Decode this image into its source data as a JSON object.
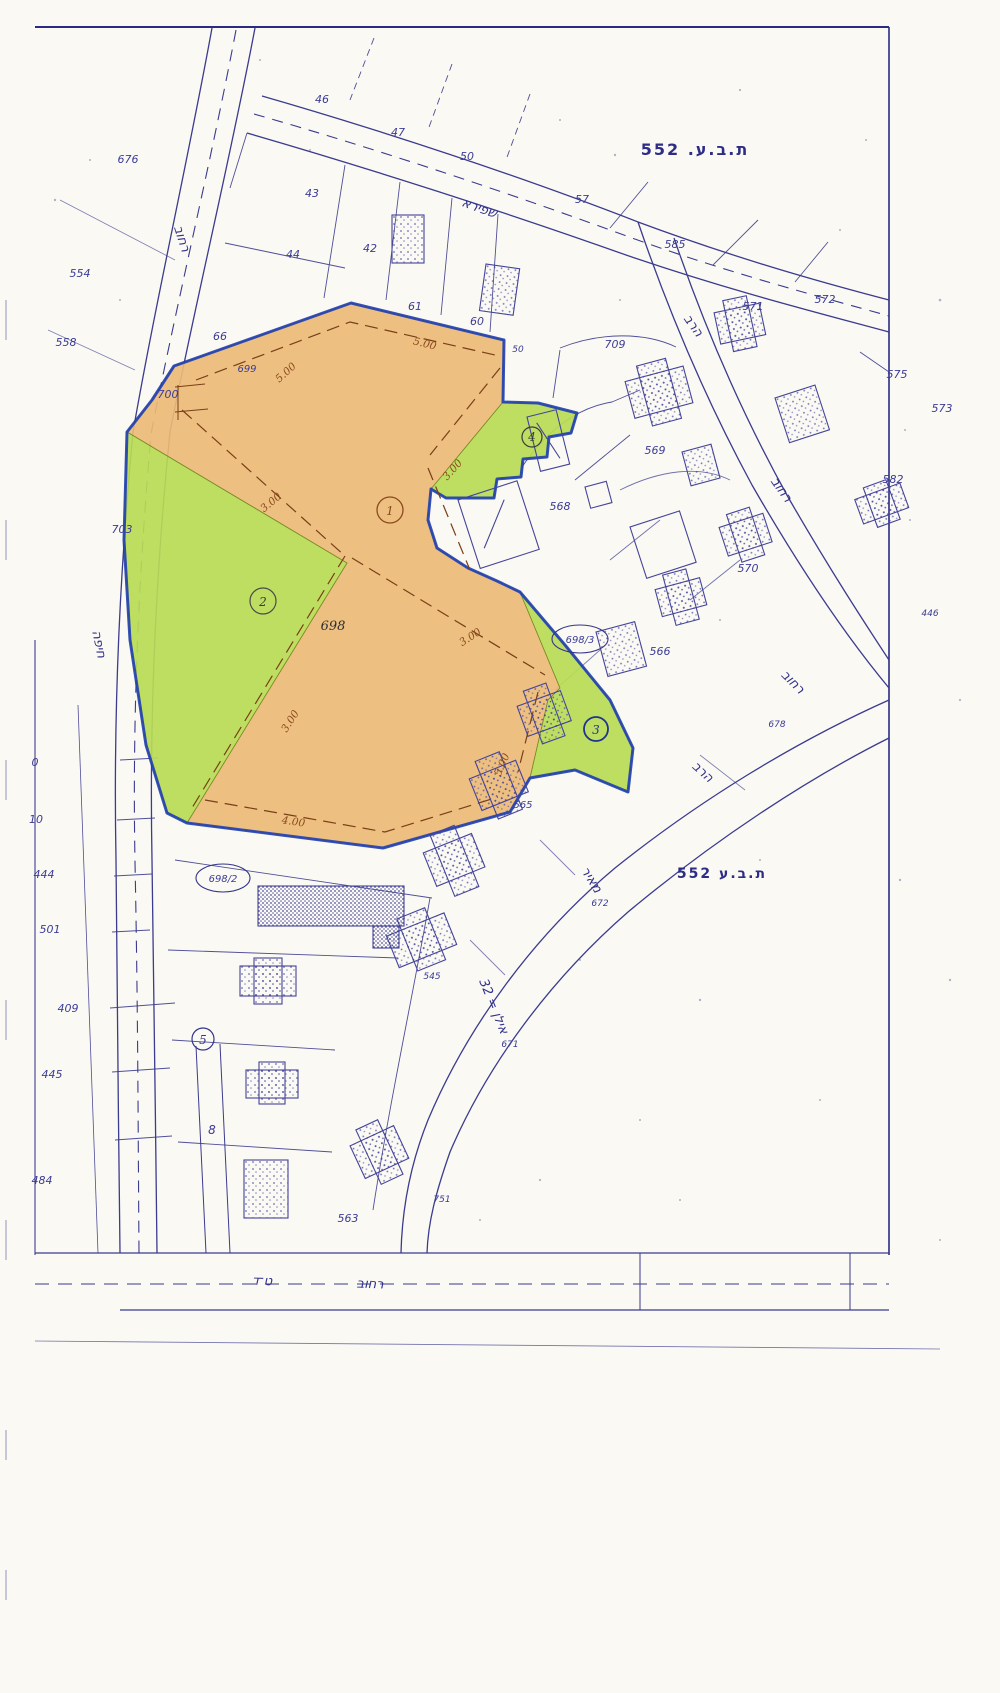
{
  "document": {
    "type": "scanned zoning plan map",
    "plan_label_top": "ת.ב.ע. 255",
    "plan_label_mid": "ת.ב.ע 255"
  },
  "colors": {
    "line_ink": "#34348c",
    "boundary_blue": "#1f3fb0",
    "zone_orange": "#ecba77",
    "zone_green": "#b9dc55",
    "dimension_brown": "#8a4a1e",
    "paper": "#faf9f3"
  },
  "streets": [
    {
      "text": "רחוב"
    },
    {
      "text": "שפירא"
    },
    {
      "text": "הרב"
    },
    {
      "text": "רחוב"
    },
    {
      "text": "רחוב"
    },
    {
      "text": "הרב"
    },
    {
      "text": "חיפה"
    },
    {
      "text": "מאיר"
    },
    {
      "text": "אילן = 23"
    },
    {
      "text": "רחוב"
    },
    {
      "text": "ט־ד"
    }
  ],
  "parcels": [
    {
      "text": "676"
    },
    {
      "text": "554"
    },
    {
      "text": "558"
    },
    {
      "text": "700"
    },
    {
      "text": "703"
    },
    {
      "text": "0"
    },
    {
      "text": "10"
    },
    {
      "text": "444"
    },
    {
      "text": "501"
    },
    {
      "text": "409"
    },
    {
      "text": "445"
    },
    {
      "text": "484"
    },
    {
      "text": "46"
    },
    {
      "text": "47"
    },
    {
      "text": "50"
    },
    {
      "text": "43"
    },
    {
      "text": "44"
    },
    {
      "text": "42"
    },
    {
      "text": "61"
    },
    {
      "text": "60"
    },
    {
      "text": "50"
    },
    {
      "text": "699"
    },
    {
      "text": "66"
    },
    {
      "text": "57"
    },
    {
      "text": "585"
    },
    {
      "text": "571"
    },
    {
      "text": "572"
    },
    {
      "text": "575"
    },
    {
      "text": "573"
    },
    {
      "text": "709"
    },
    {
      "text": "569"
    },
    {
      "text": "568"
    },
    {
      "text": "582"
    },
    {
      "text": "570"
    },
    {
      "text": "566"
    },
    {
      "text": "678"
    },
    {
      "text": "446"
    },
    {
      "text": "545"
    },
    {
      "text": "565"
    },
    {
      "text": "672"
    },
    {
      "text": "671"
    },
    {
      "text": "563"
    },
    {
      "text": "751"
    },
    {
      "text": "8"
    }
  ],
  "zone_marks": [
    {
      "text": "1"
    },
    {
      "text": "2"
    },
    {
      "text": "3"
    },
    {
      "text": "4"
    },
    {
      "text": "5"
    },
    {
      "text": "698"
    },
    {
      "text": "698/2"
    },
    {
      "text": "698/3"
    }
  ],
  "dimensions": [
    {
      "text": "5.00"
    },
    {
      "text": "5.00"
    },
    {
      "text": "3.00"
    },
    {
      "text": "3.00"
    },
    {
      "text": "3.00"
    },
    {
      "text": "3.00"
    },
    {
      "text": "5.00"
    },
    {
      "text": "4.00"
    }
  ]
}
